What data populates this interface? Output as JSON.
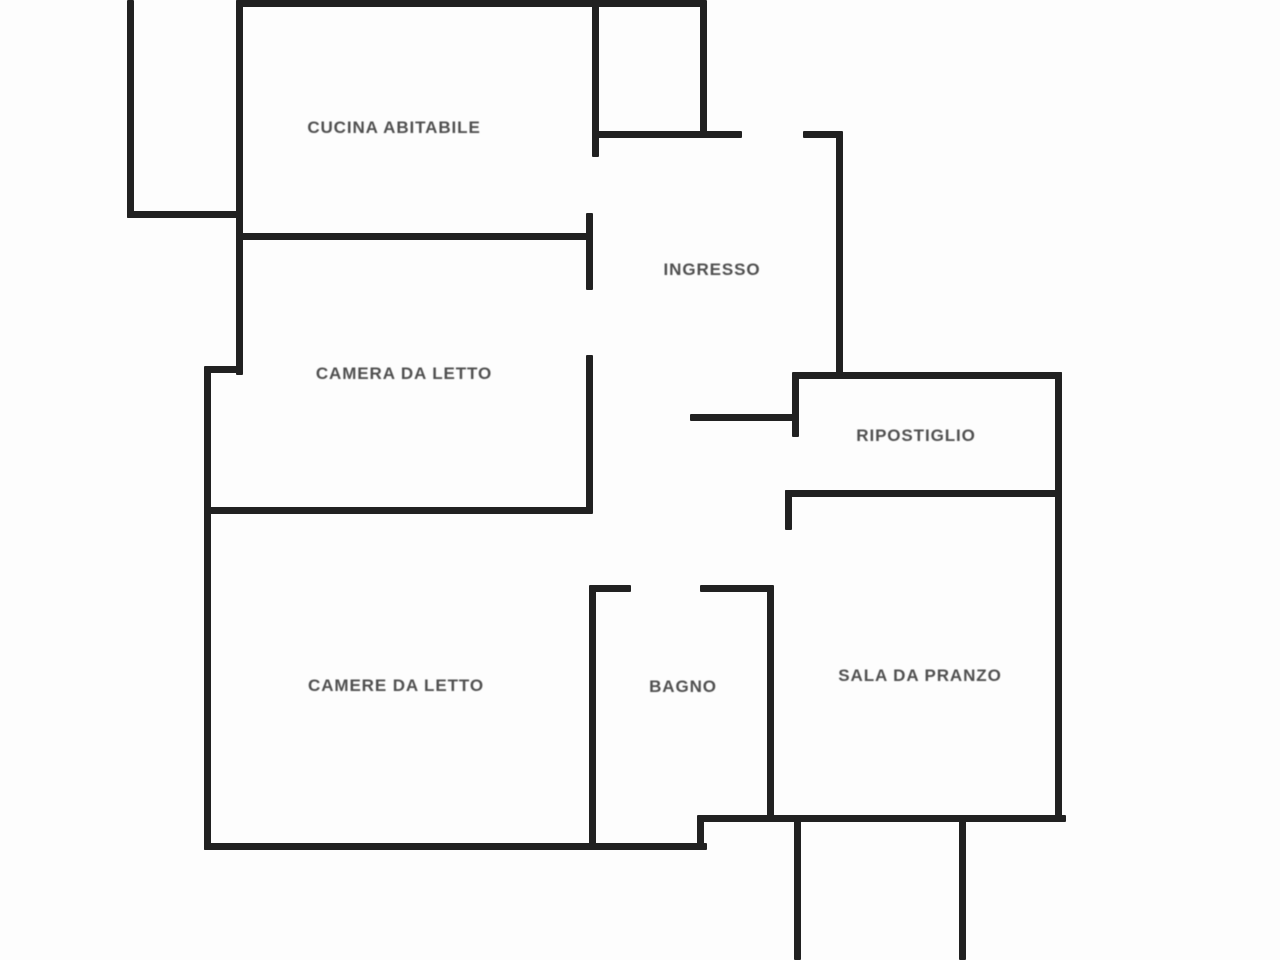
{
  "plan": {
    "background": "#fdfdfd",
    "wall_color": "#212121",
    "label_color": "#4f4f4f",
    "rooms": [
      {
        "id": "cucina-abitabile",
        "label": "CUCINA ABITABILE",
        "cx": 394,
        "cy": 128
      },
      {
        "id": "ingresso",
        "label": "INGRESSO",
        "cx": 712,
        "cy": 270
      },
      {
        "id": "camera-da-letto",
        "label": "CAMERA DA LETTO",
        "cx": 404,
        "cy": 374
      },
      {
        "id": "ripostiglio",
        "label": "RIPOSTIGLIO",
        "cx": 916,
        "cy": 436
      },
      {
        "id": "camere-da-letto",
        "label": "CAMERE DA LETTO",
        "cx": 396,
        "cy": 686
      },
      {
        "id": "bagno",
        "label": "BAGNO",
        "cx": 683,
        "cy": 687
      },
      {
        "id": "sala-da-pranzo",
        "label": "SALA DA PRANZO",
        "cx": 920,
        "cy": 676
      }
    ],
    "walls": [
      {
        "id": "outer-left-top",
        "x": 127,
        "y": 0,
        "w": 7,
        "h": 218
      },
      {
        "id": "balcony-bottom",
        "x": 127,
        "y": 211,
        "w": 116,
        "h": 7
      },
      {
        "id": "kitchen-left",
        "x": 236,
        "y": 0,
        "w": 7,
        "h": 375
      },
      {
        "id": "top-outer",
        "x": 236,
        "y": 0,
        "w": 470,
        "h": 7
      },
      {
        "id": "kitchen-right-upper",
        "x": 592,
        "y": 0,
        "w": 7,
        "h": 157
      },
      {
        "id": "entry-square-right",
        "x": 700,
        "y": 0,
        "w": 7,
        "h": 133
      },
      {
        "id": "entry-square-bottom",
        "x": 595,
        "y": 131,
        "w": 147,
        "h": 7
      },
      {
        "id": "entry-right-tick",
        "x": 803,
        "y": 131,
        "w": 40,
        "h": 7
      },
      {
        "id": "kitchen-bottom",
        "x": 236,
        "y": 233,
        "w": 357,
        "h": 7
      },
      {
        "id": "ingresso-left-upper",
        "x": 586,
        "y": 213,
        "w": 7,
        "h": 77
      },
      {
        "id": "ingresso-left-lower",
        "x": 586,
        "y": 355,
        "w": 7,
        "h": 157
      },
      {
        "id": "ingresso-right",
        "x": 836,
        "y": 135,
        "w": 7,
        "h": 243
      },
      {
        "id": "camera-left-jog",
        "x": 204,
        "y": 366,
        "w": 39,
        "h": 7
      },
      {
        "id": "bedrooms-left",
        "x": 204,
        "y": 368,
        "w": 7,
        "h": 482
      },
      {
        "id": "camera-bottom-divider",
        "x": 204,
        "y": 507,
        "w": 389,
        "h": 7
      },
      {
        "id": "hall-bottom-tick",
        "x": 690,
        "y": 414,
        "w": 109,
        "h": 7
      },
      {
        "id": "ripostiglio-top",
        "x": 792,
        "y": 372,
        "w": 270,
        "h": 7
      },
      {
        "id": "ripostiglio-left",
        "x": 792,
        "y": 375,
        "w": 7,
        "h": 62
      },
      {
        "id": "ripostiglio-bottom",
        "x": 785,
        "y": 490,
        "w": 277,
        "h": 7
      },
      {
        "id": "sala-left-jamb",
        "x": 785,
        "y": 490,
        "w": 7,
        "h": 40
      },
      {
        "id": "bagno-top-left-tick",
        "x": 589,
        "y": 585,
        "w": 42,
        "h": 7
      },
      {
        "id": "bagno-top-right-tick",
        "x": 700,
        "y": 585,
        "w": 74,
        "h": 7
      },
      {
        "id": "camere-right-bagno-left",
        "x": 589,
        "y": 588,
        "w": 7,
        "h": 262
      },
      {
        "id": "bagno-right-sala-left",
        "x": 767,
        "y": 588,
        "w": 7,
        "h": 234
      },
      {
        "id": "outer-right",
        "x": 1055,
        "y": 372,
        "w": 7,
        "h": 450
      },
      {
        "id": "camere-bottom",
        "x": 204,
        "y": 843,
        "w": 503,
        "h": 7
      },
      {
        "id": "bottom-step",
        "x": 697,
        "y": 815,
        "w": 7,
        "h": 35
      },
      {
        "id": "sala-bagno-bottom",
        "x": 700,
        "y": 815,
        "w": 366,
        "h": 7
      },
      {
        "id": "below-stub-left",
        "x": 794,
        "y": 818,
        "w": 7,
        "h": 142
      },
      {
        "id": "below-stub-right",
        "x": 959,
        "y": 818,
        "w": 7,
        "h": 142
      }
    ]
  }
}
